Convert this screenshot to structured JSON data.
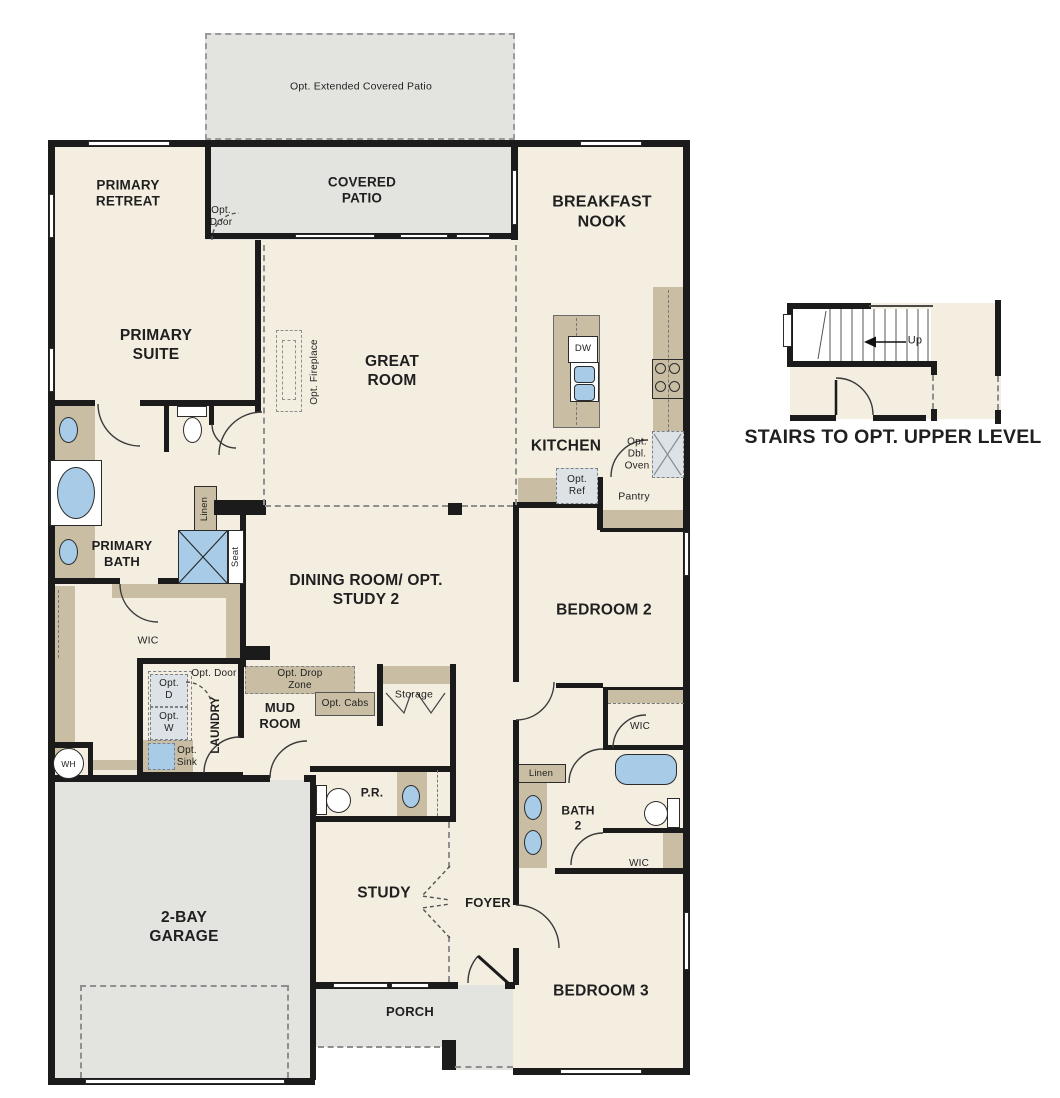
{
  "colors": {
    "floor": "#f4eee1",
    "hardscape": "#e3e3e0",
    "cabinet_tan": "#c9bda3",
    "fixture_blue": "#a8cce8",
    "optional_box": "#dde2e7",
    "wall": "#1b1b1b",
    "text": "#1f1f1f"
  },
  "rooms": {
    "opt_extended_patio": "Opt. Extended Covered Patio",
    "covered_patio": "COVERED PATIO",
    "primary_retreat": "PRIMARY RETREAT",
    "breakfast_nook": "BREAKFAST NOOK",
    "primary_suite": "PRIMARY SUITE",
    "great_room": "GREAT ROOM",
    "kitchen": "KITCHEN",
    "primary_bath": "PRIMARY BATH",
    "dining": "DINING ROOM/ OPT. STUDY 2",
    "bedroom2": "BEDROOM 2",
    "wic_primary": "WIC",
    "laundry": "LAUNDRY",
    "mud_room": "MUD ROOM",
    "storage": "Storage",
    "pantry": "Pantry",
    "pr": "P.R.",
    "bath2": "BATH 2",
    "wic_upper": "WIC",
    "wic_lower": "WIC",
    "garage": "2-BAY GARAGE",
    "study": "STUDY",
    "foyer": "FOYER",
    "bedroom3": "BEDROOM 3",
    "porch": "PORCH"
  },
  "annotations": {
    "opt_door_patio": "Opt. Door",
    "opt_fireplace": "Opt. Fireplace",
    "opt_dbl_oven": "Opt. Dbl. Oven",
    "opt_ref": "Opt. Ref",
    "linen_primary": "Linen",
    "seat": "Seat",
    "opt_d": "Opt. D",
    "opt_w": "Opt. W",
    "opt_door_laundry": "Opt. Door",
    "opt_drop_zone": "Opt. Drop Zone",
    "opt_cabs": "Opt. Cabs",
    "opt_sink": "Opt. Sink",
    "linen_bath2": "Linen",
    "dw": "DW",
    "wh": "WH"
  },
  "stairs": {
    "caption": "STAIRS TO OPT. UPPER LEVEL",
    "up": "Up"
  }
}
